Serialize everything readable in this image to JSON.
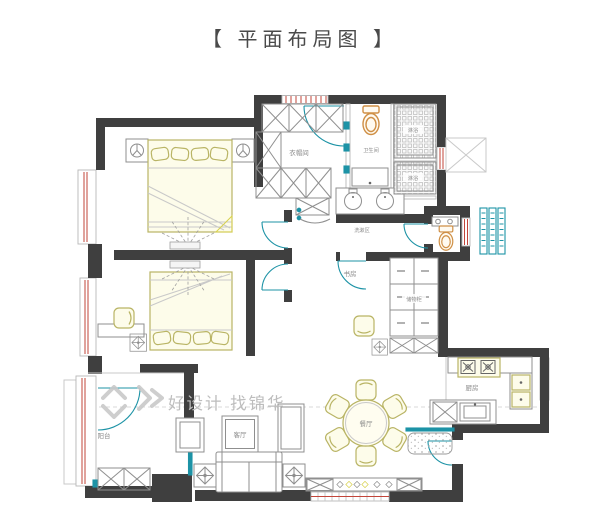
{
  "title": "【 平面布局图 】",
  "watermark": "好设计 找锦华",
  "rooms": {
    "cloakroom": "衣帽间",
    "bathroom": "卫生间",
    "shower_top": "淋浴",
    "shower_bottom": "淋浴",
    "washing_area": "洗漱区",
    "study": "书房",
    "storage_cabinet": "储物柜",
    "dining": "餐厅",
    "living": "客厅",
    "kitchen": "厨房",
    "balcony": "阳台"
  },
  "colors": {
    "wall": "#3f3f3f",
    "furniture_line": "#8f8f8f",
    "khaki": "#b9b465",
    "fixture_orange": "#cf8f45",
    "door_teal": "#1d93a6",
    "window_red": "#c2453a",
    "watermark_gray": "#bdbdbd"
  }
}
